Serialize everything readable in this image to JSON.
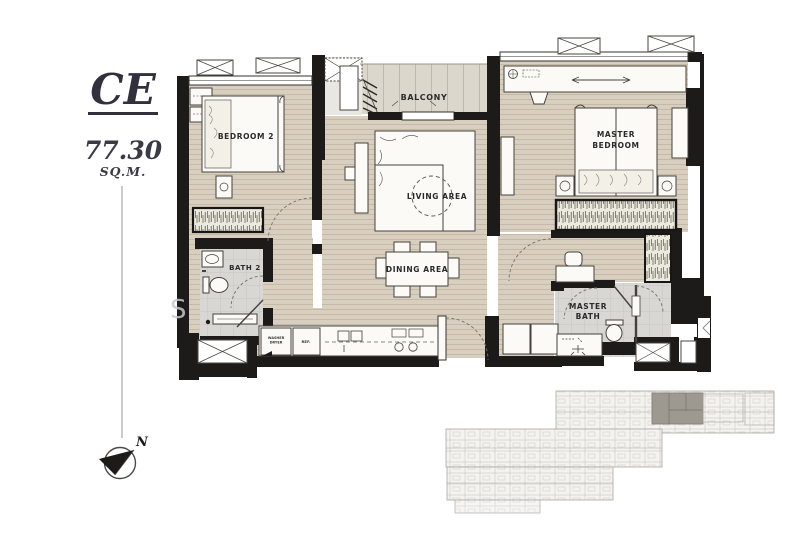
{
  "unit": {
    "code": "CE",
    "area_value": "77.30",
    "area_unit": "SQ.M."
  },
  "rooms": {
    "bedroom2": "BEDROOM 2",
    "master_bedroom_line1": "MASTER",
    "master_bedroom_line2": "BEDROOM",
    "balcony": "BALCONY",
    "living_area": "LIVING AREA",
    "dining_area": "DINING AREA",
    "bath2": "BATH 2",
    "master_bath_line1": "MASTER",
    "master_bath_line2": "BATH",
    "washer_line1": "WASHER",
    "washer_line2": "DRYER",
    "fridge": "REF."
  },
  "compass": {
    "north_label": "N"
  },
  "watermark": "S",
  "colors": {
    "wall": "#1d1b1a",
    "floor_wood": "#d9cfc0",
    "floor_plank_line": "#c0b29c",
    "floor_tile": "#d8d7d4",
    "balcony_floor": "#dcd7cc",
    "furniture_fill": "#fbfaf7",
    "furniture_outline": "#45413a",
    "title_color": "#31303c",
    "keyplan_line": "#a9a7a3",
    "keyplan_highlight": "#9d9890"
  }
}
